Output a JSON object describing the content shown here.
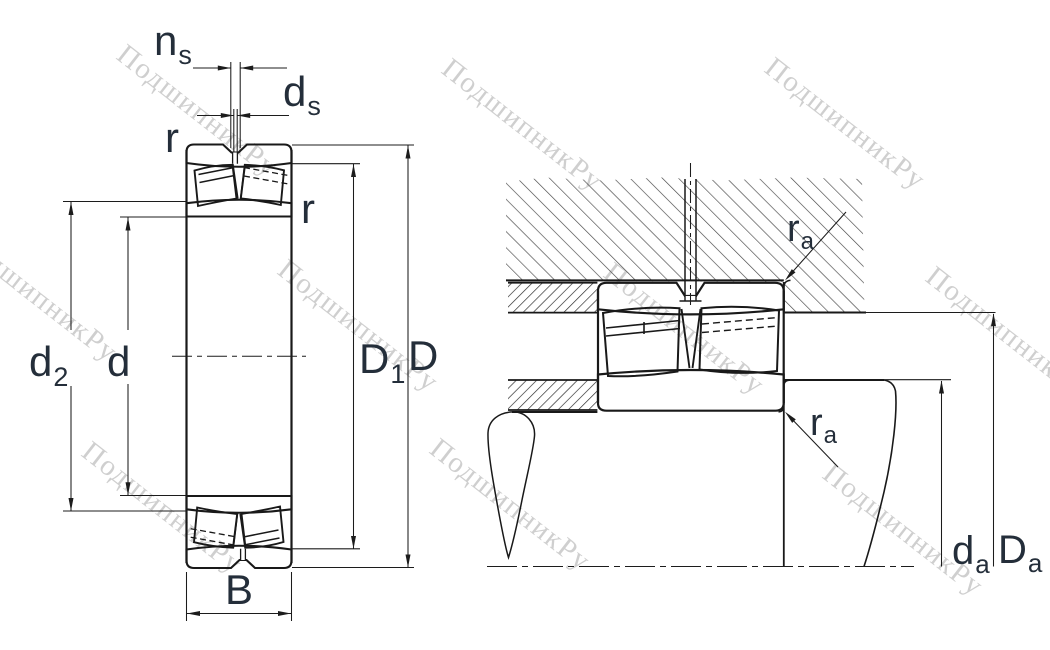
{
  "drawing": {
    "watermark": {
      "text": "ПодшипникРу",
      "color": "#c7c7c7"
    },
    "colors": {
      "outline": "#191919",
      "dim": "#1c1c1c",
      "label": "#242e3a",
      "hatch_dark": "#2a2a2a",
      "hatch_light": "#474747",
      "background": "#ffffff"
    },
    "labels": {
      "ns_main": "n",
      "ns_sub": "s",
      "ds_main": "d",
      "ds_sub": "s",
      "r_outer": "r",
      "r_inner": "r",
      "d2_main": "d",
      "d2_sub": "2",
      "d_main": "d",
      "D1_main": "D",
      "D1_sub": "1",
      "D_main": "D",
      "B_main": "B",
      "ra_top_main": "r",
      "ra_top_sub": "a",
      "ra_bottom_main": "r",
      "ra_bottom_sub": "a",
      "da_main": "d",
      "da_sub": "a",
      "Da_main": "D",
      "Da_sub": "a"
    }
  }
}
